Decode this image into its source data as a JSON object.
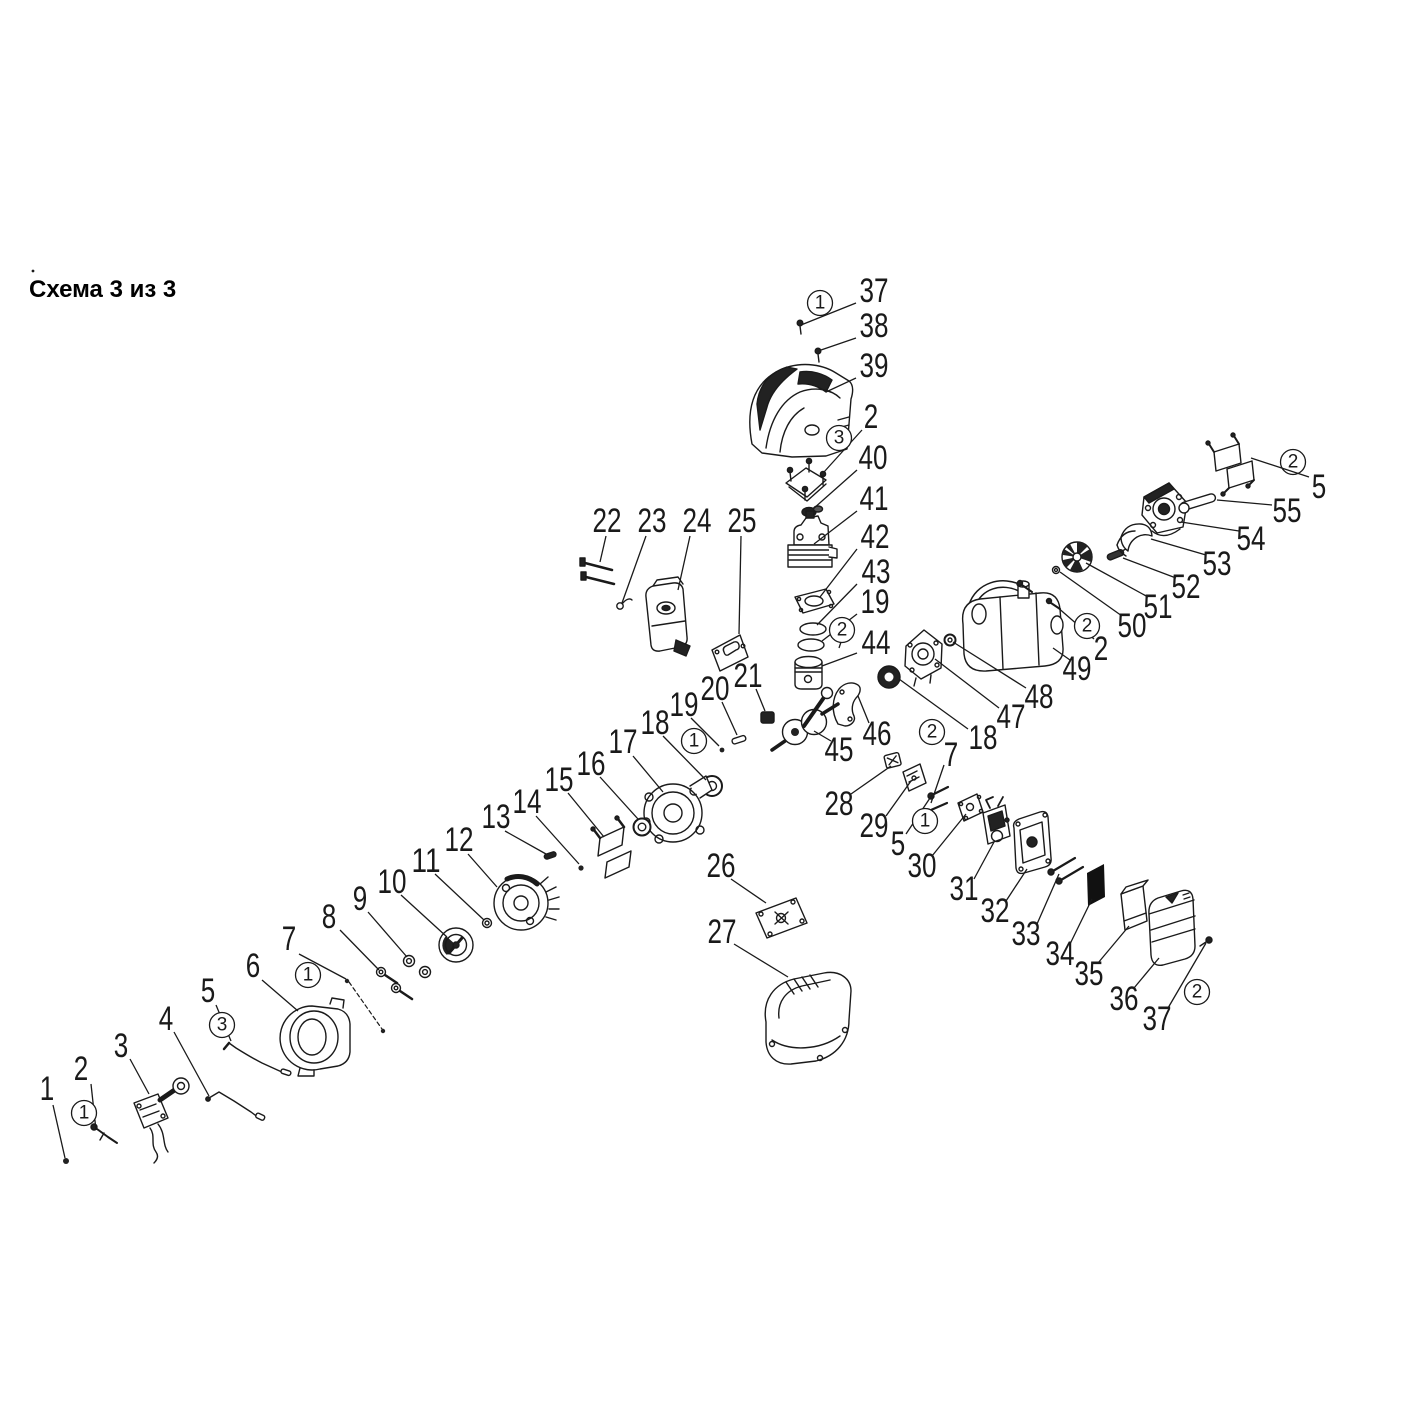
{
  "title": {
    "text": "Схема 3 из 3"
  },
  "diagram": {
    "ink": "#1a1a1a",
    "background": "#ffffff",
    "callouts": [
      {
        "label": "37",
        "x": 874,
        "y": 291,
        "line": [
          856,
          303,
          801,
          325
        ]
      },
      {
        "label": "1",
        "circled": true,
        "x": 820,
        "y": 303
      },
      {
        "label": "38",
        "x": 874,
        "y": 326,
        "line": [
          856,
          338,
          821,
          350
        ]
      },
      {
        "label": "39",
        "x": 874,
        "y": 366,
        "line": [
          856,
          378,
          826,
          392
        ]
      },
      {
        "label": "2",
        "x": 871,
        "y": 417,
        "line": [
          862,
          430,
          824,
          472
        ]
      },
      {
        "label": "3",
        "circled": true,
        "x": 839,
        "y": 438
      },
      {
        "label": "40",
        "x": 873,
        "y": 458,
        "line": [
          857,
          470,
          813,
          509
        ]
      },
      {
        "label": "41",
        "x": 874,
        "y": 499,
        "line": [
          857,
          511,
          814,
          544
        ]
      },
      {
        "label": "42",
        "x": 875,
        "y": 537,
        "line": [
          857,
          549,
          820,
          597
        ]
      },
      {
        "label": "43",
        "x": 876,
        "y": 572,
        "line": [
          857,
          584,
          817,
          625
        ]
      },
      {
        "label": "19",
        "x": 875,
        "y": 602,
        "line": [
          857,
          614,
          822,
          641
        ]
      },
      {
        "label": "2",
        "circled": true,
        "x": 842,
        "y": 630,
        "line": [
          841,
          642,
          839,
          648
        ]
      },
      {
        "label": "44",
        "x": 876,
        "y": 643,
        "line": [
          857,
          653,
          822,
          666
        ]
      },
      {
        "label": "22",
        "x": 607,
        "y": 521,
        "line": [
          606,
          536,
          600,
          562
        ]
      },
      {
        "label": "23",
        "x": 652,
        "y": 521,
        "line": [
          646,
          536,
          622,
          603
        ]
      },
      {
        "label": "24",
        "x": 697,
        "y": 521,
        "line": [
          690,
          536,
          678,
          590
        ]
      },
      {
        "label": "25",
        "x": 742,
        "y": 521,
        "line": [
          741,
          536,
          739,
          634
        ]
      },
      {
        "label": "21",
        "x": 748,
        "y": 676,
        "line": [
          756,
          689,
          765,
          711
        ]
      },
      {
        "label": "20",
        "x": 715,
        "y": 689,
        "line": [
          722,
          702,
          737,
          735
        ]
      },
      {
        "label": "19",
        "x": 684,
        "y": 705,
        "line": [
          691,
          718,
          719,
          746
        ]
      },
      {
        "label": "18",
        "x": 655,
        "y": 723,
        "line": [
          663,
          736,
          706,
          780
        ]
      },
      {
        "label": "1",
        "circled": true,
        "x": 694,
        "y": 741
      },
      {
        "label": "17",
        "x": 623,
        "y": 742,
        "line": [
          633,
          756,
          663,
          792
        ]
      },
      {
        "label": "16",
        "x": 591,
        "y": 764,
        "line": [
          600,
          777,
          638,
          819
        ]
      },
      {
        "label": "15",
        "x": 559,
        "y": 780,
        "line": [
          568,
          793,
          604,
          837
        ]
      },
      {
        "label": "14",
        "x": 527,
        "y": 802,
        "line": [
          536,
          816,
          579,
          864
        ]
      },
      {
        "label": "13",
        "x": 496,
        "y": 817,
        "line": [
          505,
          831,
          546,
          854
        ]
      },
      {
        "label": "12",
        "x": 459,
        "y": 840,
        "line": [
          468,
          854,
          497,
          887
        ]
      },
      {
        "label": "11",
        "x": 426,
        "y": 861,
        "line": [
          435,
          874,
          484,
          920
        ]
      },
      {
        "label": "10",
        "x": 392,
        "y": 882,
        "line": [
          401,
          895,
          447,
          937
        ]
      },
      {
        "label": "9",
        "x": 360,
        "y": 899,
        "line": [
          368,
          912,
          407,
          957
        ]
      },
      {
        "label": "8",
        "x": 329,
        "y": 917,
        "line": [
          340,
          930,
          379,
          970
        ]
      },
      {
        "label": "7",
        "x": 289,
        "y": 939,
        "line": [
          299,
          954,
          346,
          979
        ]
      },
      {
        "label": "1",
        "circled": true,
        "x": 308,
        "y": 975
      },
      {
        "label": "6",
        "x": 253,
        "y": 966,
        "line": [
          262,
          980,
          298,
          1011
        ]
      },
      {
        "label": "5",
        "x": 208,
        "y": 991,
        "line": [
          216,
          1005,
          231,
          1041
        ]
      },
      {
        "label": "3",
        "circled": true,
        "x": 222,
        "y": 1025
      },
      {
        "label": "4",
        "x": 166,
        "y": 1019,
        "line": [
          174,
          1032,
          209,
          1096
        ]
      },
      {
        "label": "3",
        "x": 121,
        "y": 1046,
        "line": [
          130,
          1059,
          149,
          1094
        ]
      },
      {
        "label": "2",
        "x": 81,
        "y": 1069,
        "line": [
          91,
          1084,
          96,
          1130
        ]
      },
      {
        "label": "1",
        "circled": true,
        "x": 84,
        "y": 1113
      },
      {
        "label": "1",
        "x": 47,
        "y": 1089,
        "line": [
          53,
          1105,
          65,
          1158
        ]
      },
      {
        "label": "26",
        "x": 721,
        "y": 866,
        "line": [
          731,
          879,
          766,
          903
        ]
      },
      {
        "label": "27",
        "x": 722,
        "y": 932,
        "line": [
          734,
          944,
          788,
          977
        ]
      },
      {
        "label": "45",
        "x": 839,
        "y": 750,
        "line": [
          831,
          741,
          814,
          731
        ]
      },
      {
        "label": "46",
        "x": 877,
        "y": 734,
        "line": [
          869,
          723,
          858,
          696
        ]
      },
      {
        "label": "2",
        "circled": true,
        "x": 932,
        "y": 732
      },
      {
        "label": "7",
        "x": 951,
        "y": 755,
        "line": [
          944,
          765,
          931,
          803
        ]
      },
      {
        "label": "18",
        "x": 983,
        "y": 738,
        "line": [
          968,
          729,
          899,
          679
        ]
      },
      {
        "label": "47",
        "x": 1011,
        "y": 717,
        "line": [
          999,
          708,
          935,
          659
        ]
      },
      {
        "label": "48",
        "x": 1039,
        "y": 697,
        "line": [
          1026,
          688,
          953,
          642
        ]
      },
      {
        "label": "49",
        "x": 1077,
        "y": 669,
        "line": [
          1070,
          660,
          1053,
          648
        ]
      },
      {
        "label": "2",
        "x": 1101,
        "y": 649,
        "line": [
          1094,
          639,
          1056,
          606
        ]
      },
      {
        "label": "2",
        "circled": true,
        "x": 1087,
        "y": 626
      },
      {
        "label": "50",
        "x": 1132,
        "y": 626,
        "line": [
          1122,
          616,
          1060,
          572
        ]
      },
      {
        "label": "51",
        "x": 1158,
        "y": 607,
        "line": [
          1148,
          597,
          1086,
          563
        ]
      },
      {
        "label": "52",
        "x": 1186,
        "y": 587,
        "line": [
          1176,
          578,
          1123,
          558
        ]
      },
      {
        "label": "53",
        "x": 1217,
        "y": 564,
        "line": [
          1206,
          555,
          1151,
          539
        ]
      },
      {
        "label": "54",
        "x": 1251,
        "y": 539,
        "line": [
          1239,
          531,
          1181,
          522
        ]
      },
      {
        "label": "55",
        "x": 1287,
        "y": 511,
        "line": [
          1272,
          505,
          1217,
          500
        ]
      },
      {
        "label": "2",
        "circled": true,
        "x": 1293,
        "y": 462
      },
      {
        "label": "5",
        "x": 1319,
        "y": 487,
        "line": [
          1309,
          477,
          1251,
          458
        ]
      },
      {
        "label": "28",
        "x": 839,
        "y": 804,
        "line": [
          851,
          794,
          891,
          766
        ]
      },
      {
        "label": "29",
        "x": 874,
        "y": 826,
        "line": [
          886,
          816,
          911,
          781
        ]
      },
      {
        "label": "5",
        "x": 898,
        "y": 844,
        "line": [
          906,
          834,
          932,
          795
        ]
      },
      {
        "label": "1",
        "circled": true,
        "x": 925,
        "y": 821
      },
      {
        "label": "30",
        "x": 922,
        "y": 866,
        "line": [
          932,
          856,
          966,
          814
        ]
      },
      {
        "label": "31",
        "x": 964,
        "y": 889,
        "line": [
          974,
          879,
          994,
          842
        ]
      },
      {
        "label": "32",
        "x": 995,
        "y": 911,
        "line": [
          1006,
          901,
          1027,
          869
        ]
      },
      {
        "label": "33",
        "x": 1026,
        "y": 934,
        "line": [
          1037,
          924,
          1059,
          874
        ]
      },
      {
        "label": "34",
        "x": 1060,
        "y": 954,
        "line": [
          1070,
          944,
          1092,
          899
        ]
      },
      {
        "label": "35",
        "x": 1089,
        "y": 974,
        "line": [
          1098,
          963,
          1129,
          926
        ]
      },
      {
        "label": "36",
        "x": 1124,
        "y": 999,
        "line": [
          1134,
          988,
          1159,
          958
        ]
      },
      {
        "label": "37",
        "x": 1157,
        "y": 1019,
        "line": [
          1168,
          1008,
          1206,
          943
        ]
      },
      {
        "label": "2",
        "circled": true,
        "x": 1197,
        "y": 992
      }
    ]
  }
}
